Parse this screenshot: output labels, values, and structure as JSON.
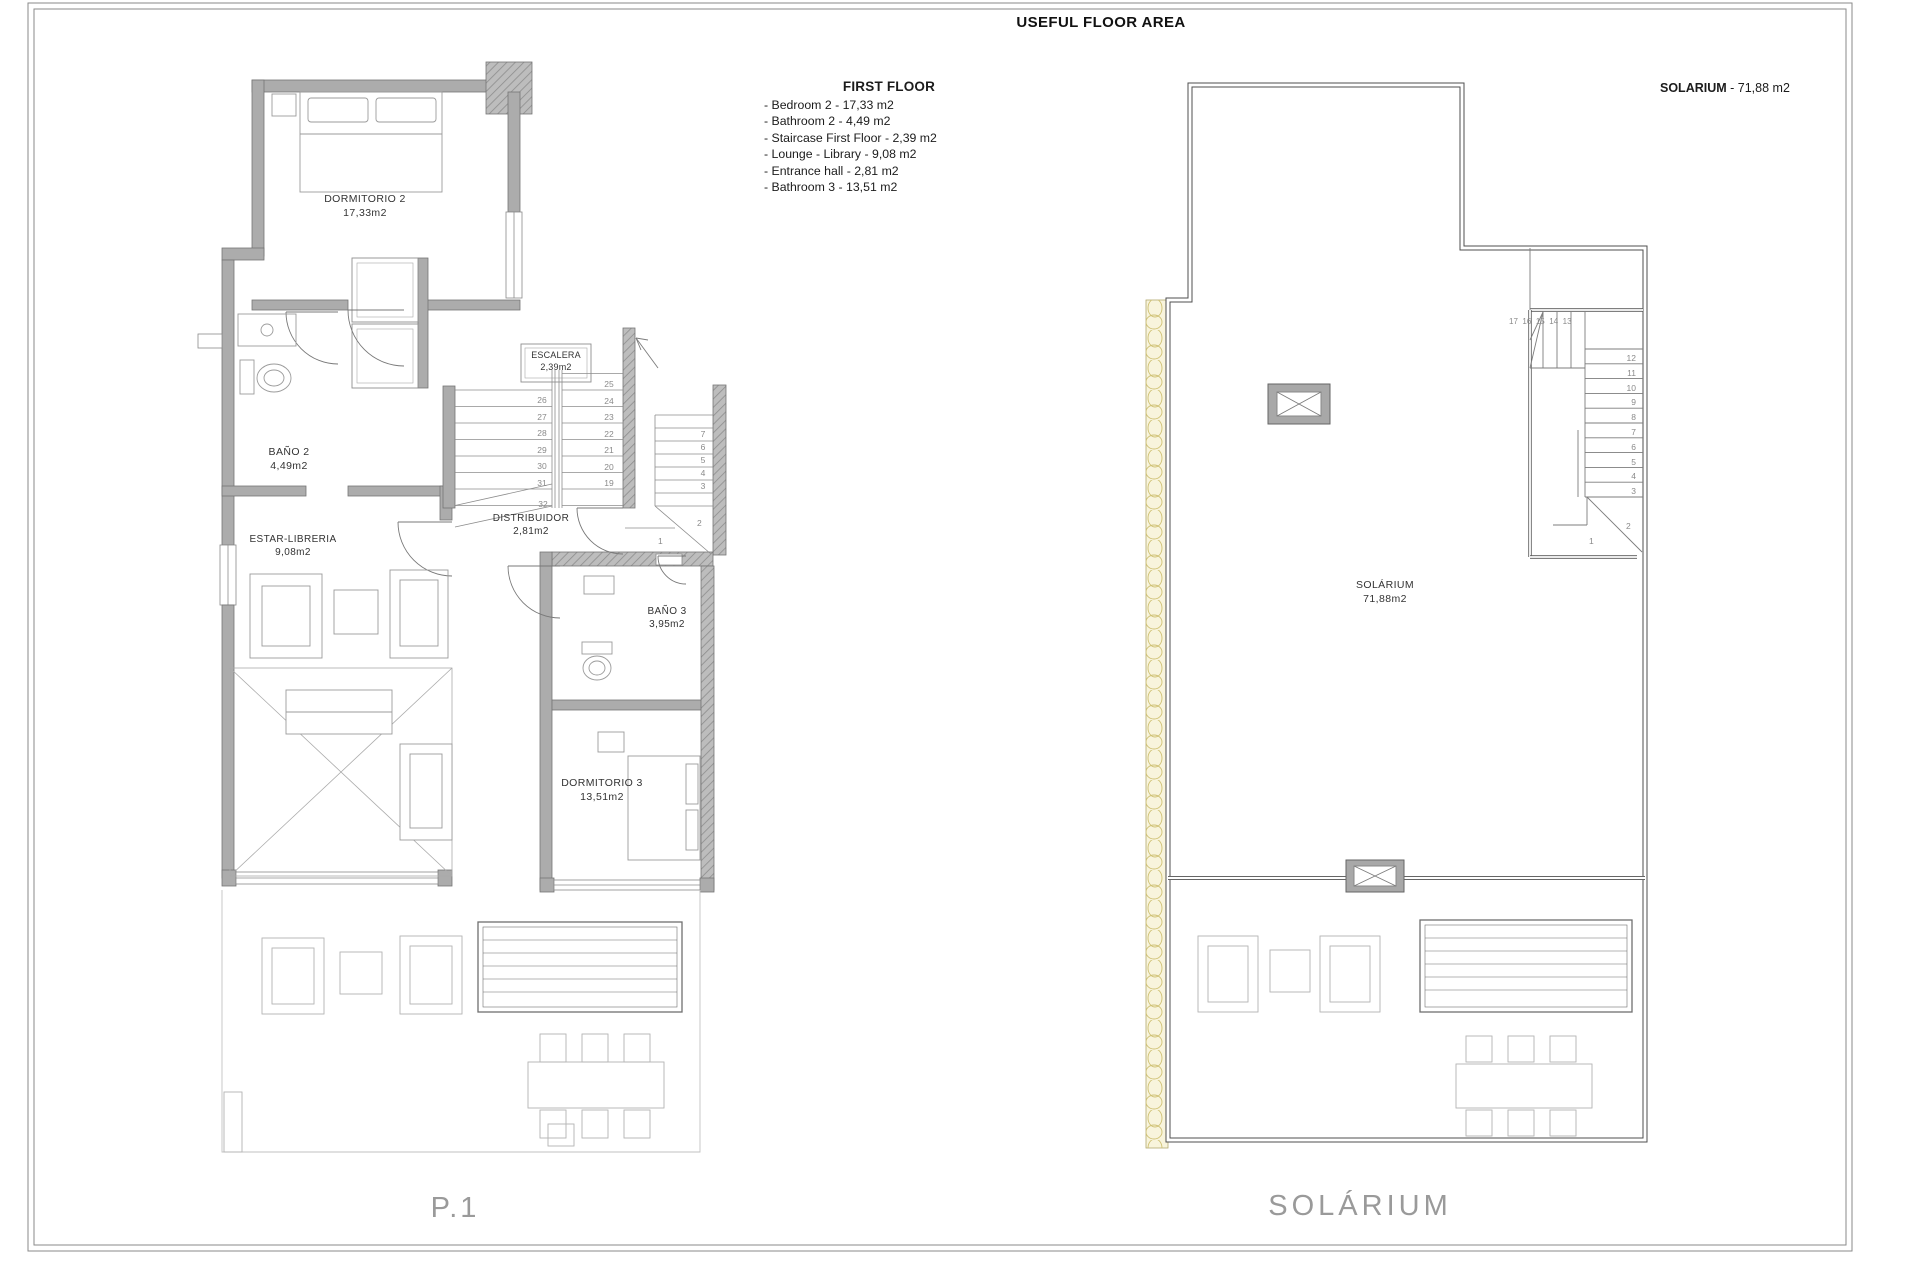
{
  "sheet": {
    "title": "USEFUL FLOOR AREA"
  },
  "legend": {
    "heading": "FIRST FLOOR",
    "items": [
      "- Bedroom 2 - 17,33 m2",
      "- Bathroom 2 - 4,49 m2",
      "- Staircase First Floor - 2,39 m2",
      "- Lounge - Library - 9,08 m2",
      "- Entrance hall - 2,81 m2",
      "- Bathroom 3 - 13,51 m2"
    ]
  },
  "solarium_note": {
    "label": "SOLARIUM",
    "rest": " - 71,88 m2"
  },
  "first_floor": {
    "caption": "P.1",
    "rooms": {
      "dormitorio2": {
        "name": "DORMITORIO 2",
        "area": "17,33m2"
      },
      "bano2": {
        "name": "BAÑO 2",
        "area": "4,49m2"
      },
      "escalera": {
        "name": "ESCALERA",
        "area": "2,39m2"
      },
      "distribuidor": {
        "name": "DISTRIBUIDOR",
        "area": "2,81m2"
      },
      "estar": {
        "name": "ESTAR-LIBRERIA",
        "area": "9,08m2"
      },
      "bano3": {
        "name": "BAÑO 3",
        "area": "3,95m2"
      },
      "dormitorio3": {
        "name": "DORMITORIO 3",
        "area": "13,51m2"
      }
    },
    "stairs": {
      "flight_a": [
        "26",
        "27",
        "28",
        "29",
        "30",
        "31"
      ],
      "flight_a_last": "32",
      "flight_b": [
        "25",
        "24",
        "23",
        "22",
        "21",
        "20",
        "19"
      ],
      "flight_c": [
        "7",
        "6",
        "5",
        "4",
        "3"
      ],
      "winder_2": "2",
      "winder_1": "1"
    }
  },
  "solarium": {
    "caption": "SOLÁRIUM",
    "room": {
      "name": "SOLÁRIUM",
      "area": "71,88m2"
    },
    "stairs": {
      "top_row": [
        "17",
        "16",
        "15",
        "14",
        "13"
      ],
      "down_col": [
        "12",
        "11",
        "10",
        "9",
        "8",
        "7",
        "6",
        "5",
        "4",
        "3"
      ],
      "winder_2": "2",
      "winder_1": "1"
    }
  }
}
